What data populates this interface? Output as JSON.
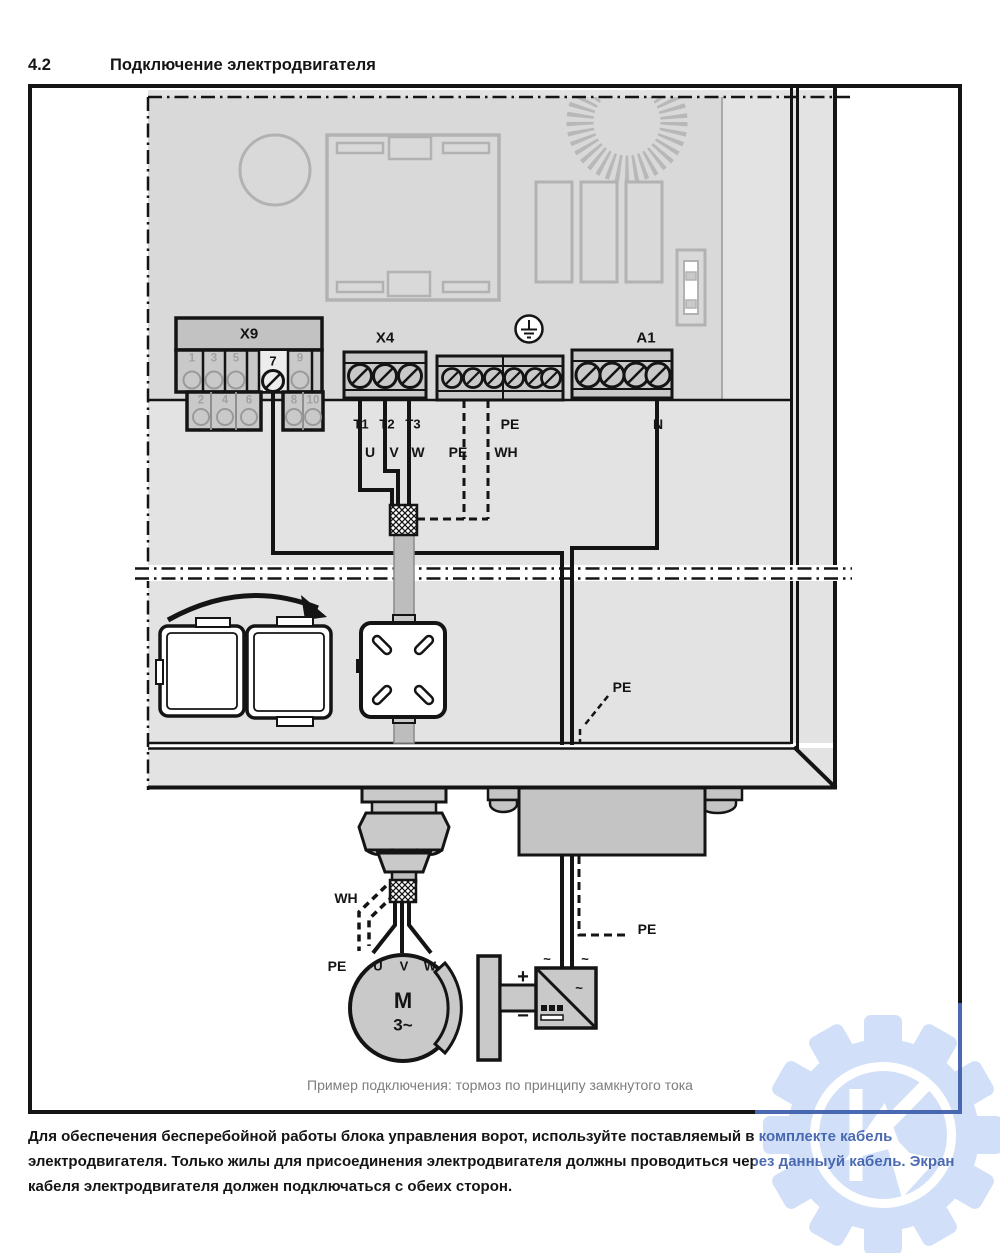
{
  "header": {
    "section": "4.2",
    "title": "Подключение электродвигателя"
  },
  "board": {
    "x9": {
      "label": "X9",
      "top": [
        "1",
        "3",
        "5",
        "7",
        "9"
      ],
      "bottom": [
        "2",
        "4",
        "6",
        "8",
        "10"
      ],
      "highlighted": "7"
    },
    "x4": {
      "label": "X4"
    },
    "a1": {
      "label": "A1"
    }
  },
  "wires": {
    "t1": "T1",
    "t2": "T2",
    "t3": "T3",
    "u": "U",
    "v": "V",
    "w": "W",
    "pe1": "PE",
    "wh": "WH",
    "pe_top": "PE",
    "n": "N",
    "pe_mid": "PE",
    "wh_motor": "WH",
    "pe_motor": "PE",
    "pe_out": "PE"
  },
  "motor": {
    "u": "U",
    "v": "V",
    "w": "W",
    "m": "M",
    "phase": "3~"
  },
  "rectifier": {
    "plus": "+",
    "minus": "−",
    "ac_left": "~",
    "ac_right": "~",
    "ac_inner": "~"
  },
  "caption": "Пример подключения: тормоз по принципу замкнутого тока",
  "note": "Для обеспечения бесперебойной работы блока управления ворот, используйте поставляемый в комплекте кабель электродвигателя. Только жилы для присоединения электродвигателя должны проводиться через данныуй кабель. Экран кабеля электродвигателя должен подключаться с обеих сторон.",
  "watermark": {
    "letter": "К"
  },
  "colors": {
    "accent_blue": "#3b5cab",
    "watermark_fill": "#c3cfe9",
    "panel_gray": "#e3e3e3",
    "pcb_gray": "#d9d9d9"
  }
}
